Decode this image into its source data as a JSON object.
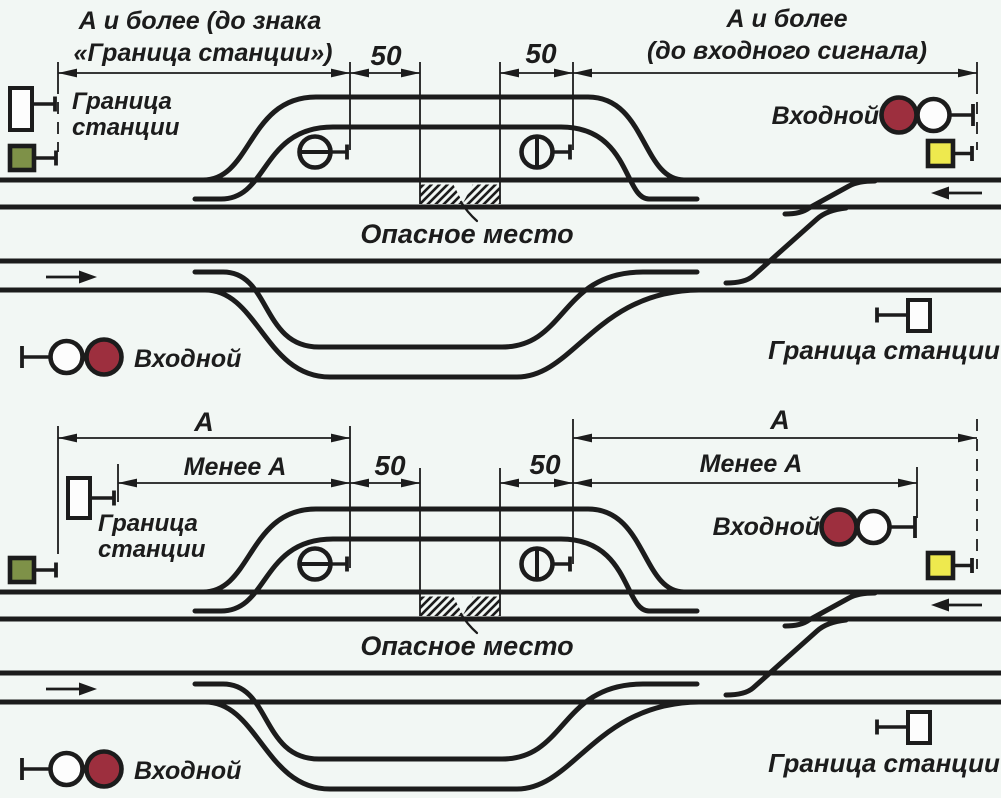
{
  "colors": {
    "background": "#f2f7f4",
    "ink": "#1c1c1c",
    "red_lamp": "#9d2f3e",
    "white_lamp": "#fdfdfd",
    "yellow_sign": "#eee94e",
    "green_sign": "#7e9148"
  },
  "icons": {
    "entrance-signal-icon": "two circles (red + white) on a mast",
    "shunting-dwarf-signal-icon": "circle with bar on a mast",
    "station-boundary-sign-icon": "white rectangle on a mast",
    "green-square-sign-icon": "green square on a mast",
    "yellow-square-sign-icon": "yellow square on a mast",
    "danger-zone-icon": "diagonal hatched strip between tracks",
    "direction-arrow-icon": "filled arrow showing train direction"
  },
  "top": {
    "dim_left_1": "А и более (до знака",
    "dim_left_2": "«Граница станции»)",
    "dim_50_left": "50",
    "dim_50_right": "50",
    "dim_right_1": "А и более",
    "dim_right_2": "(до входного сигнала)",
    "boundary_left_1": "Граница",
    "boundary_left_2": "станции",
    "entrance_right": "Входной",
    "danger": "Опасное место",
    "entrance_left": "Входной",
    "boundary_right": "Граница станции"
  },
  "bottom": {
    "dim_a_left": "А",
    "dim_menee_left": "Менее А",
    "dim_50_left": "50",
    "dim_50_right": "50",
    "dim_a_right": "А",
    "dim_menee_right": "Менее А",
    "boundary_left_1": "Граница",
    "boundary_left_2": "станции",
    "entrance_right": "Входной",
    "danger": "Опасное место",
    "entrance_left": "Входной",
    "boundary_right": "Граница станции"
  }
}
